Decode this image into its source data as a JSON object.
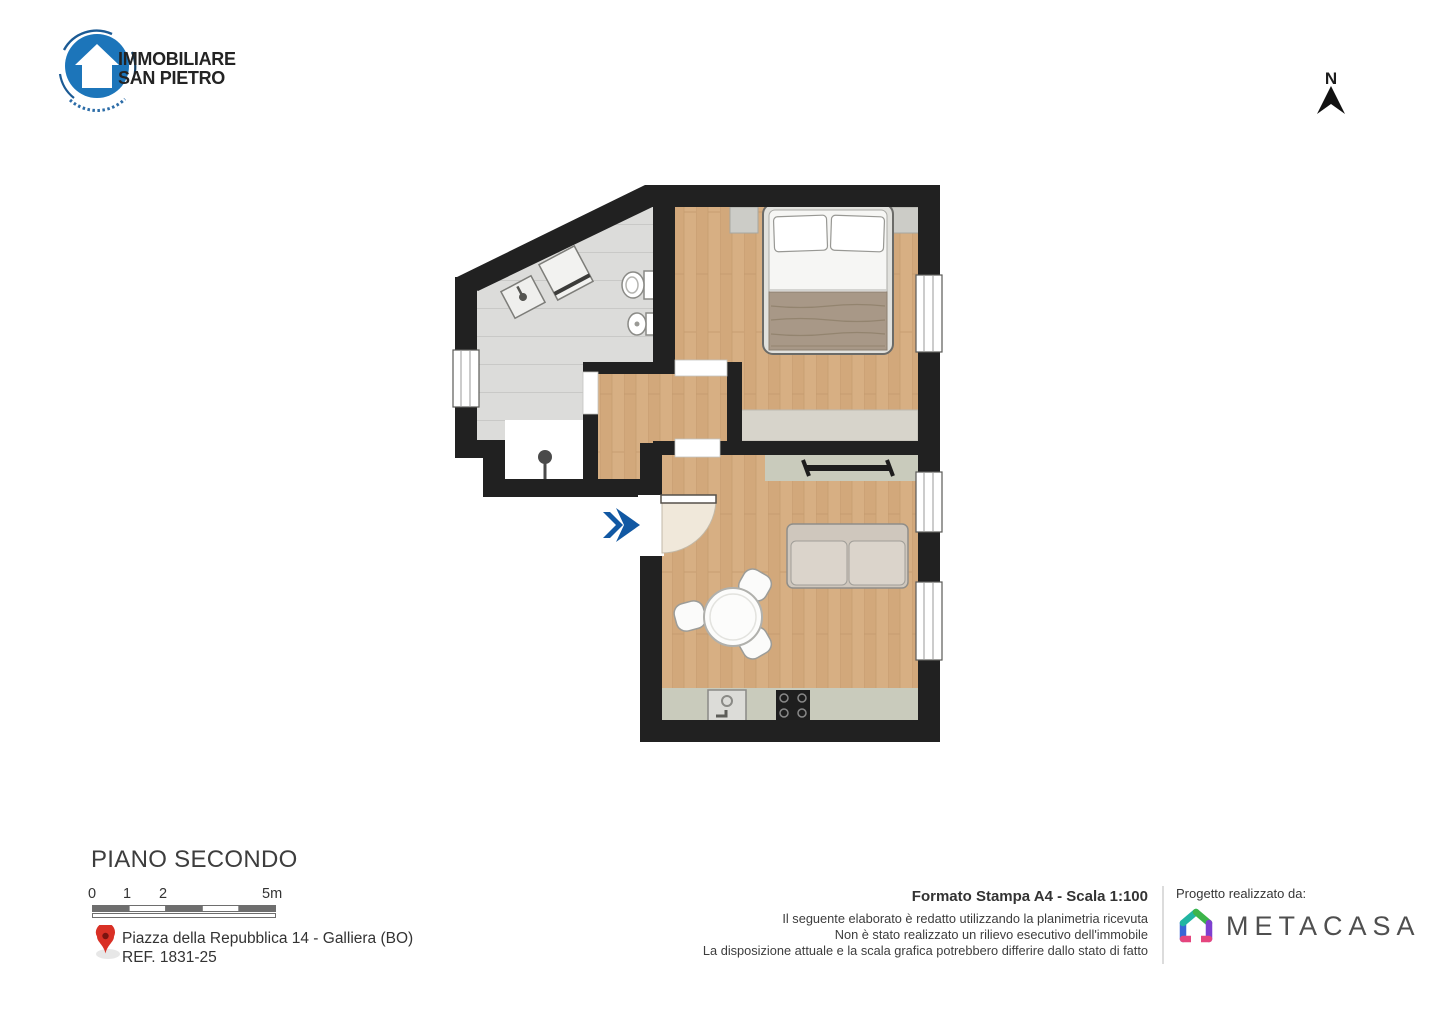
{
  "colors": {
    "accent_blue": "#1158a3",
    "logo_blue": "#1c75ba",
    "wall_black": "#212121",
    "wood_floor": "#d6ae82",
    "tile_floor": "#dcdcda",
    "kitchen_gray_green": "#c9cbbc",
    "wardrobe_beige": "#d7d4cb",
    "pin_red": "#d93025",
    "metacasa_green": "#3cb54a",
    "metacasa_teal": "#21b5a2",
    "metacasa_blue": "#3a66d6",
    "metacasa_purple": "#7e3fd0",
    "metacasa_pink": "#e5457e"
  },
  "header": {
    "agency_logo": {
      "line1": "IMMOBILIARE",
      "line2": "SAN PIETRO"
    },
    "compass": {
      "label": "N"
    }
  },
  "footer": {
    "floor_title": "PIANO SECONDO",
    "scale_labels": [
      "0",
      "1",
      "2",
      "5m"
    ],
    "address": {
      "line1": "Piazza della Repubblica 14 - Galliera (BO)",
      "line2": "REF. 1831-25"
    },
    "print_format": "Formato Stampa A4 - Scala 1:100",
    "disclaimer_lines": [
      "Il seguente elaborato è redatto utilizzando la planimetria ricevuta",
      "Non è stato realizzato un rilievo esecutivo dell'immobile",
      "La disposizione attuale e la scala grafica potrebbero differire dallo stato di fatto"
    ],
    "credit": {
      "label": "Progetto realizzato da:",
      "brand": "METACASA"
    }
  }
}
